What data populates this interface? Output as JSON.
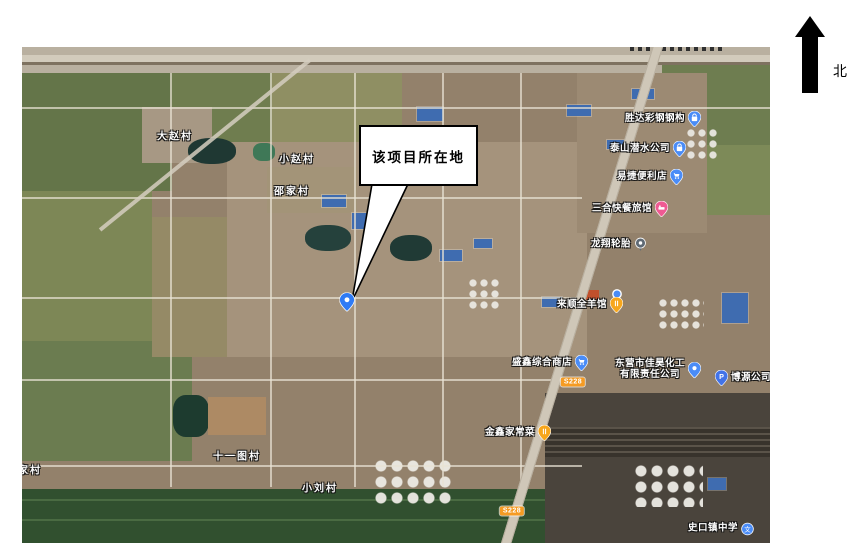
{
  "figure": {
    "north_label": "北"
  },
  "callout": {
    "text": "该项目所在地"
  },
  "map": {
    "villages": [
      {
        "label": "大赵村",
        "x": 153,
        "y": 88
      },
      {
        "label": "小赵村",
        "x": 275,
        "y": 111
      },
      {
        "label": "邵家村",
        "x": 270,
        "y": 143
      },
      {
        "label": "十一图村",
        "x": 215,
        "y": 408
      },
      {
        "label": "小刘村",
        "x": 298,
        "y": 440
      },
      {
        "label": "家村",
        "x": 8,
        "y": 422
      }
    ],
    "pois": [
      {
        "label": "胜达彩钢钢构",
        "icon": "bag",
        "x": 641,
        "y": 72
      },
      {
        "label": "泰山潜水公司",
        "icon": "bag",
        "x": 626,
        "y": 102
      },
      {
        "label": "易捷便利店",
        "icon": "cart",
        "x": 628,
        "y": 130
      },
      {
        "label": "三合快餐旅馆",
        "icon": "bed",
        "x": 608,
        "y": 162
      },
      {
        "label": "龙翔轮胎",
        "icon": "dot-marker",
        "x": 597,
        "y": 198
      },
      {
        "label": "",
        "icon": "blue-dot",
        "x": 595,
        "y": 247
      },
      {
        "label": "来顺全羊馆",
        "icon": "food",
        "x": 568,
        "y": 258
      },
      {
        "label": "盛鑫综合商店",
        "icon": "cart",
        "x": 528,
        "y": 316
      },
      {
        "label": "东营市佳昊化工",
        "label2": "有限责任公司",
        "icon": "pin",
        "x": 636,
        "y": 323
      },
      {
        "label": "博源公司停车场",
        "icon": "parking",
        "icon_first": true,
        "x": 736,
        "y": 331
      },
      {
        "label": "金鑫家常菜",
        "icon": "food",
        "x": 496,
        "y": 386
      },
      {
        "label": "史口镇中学",
        "icon": "school",
        "x": 699,
        "y": 482
      },
      {
        "label": "",
        "icon": "project-pin",
        "x": 325,
        "y": 255
      }
    ],
    "road_badges": [
      {
        "text": "S228",
        "x": 551,
        "y": 335
      },
      {
        "text": "S228",
        "x": 490,
        "y": 464
      }
    ]
  },
  "colors": {
    "poi_blue": "#4a8cf7",
    "poi_pink": "#ef5a93",
    "poi_orange": "#f7a61b",
    "poi_gray": "#5f6a75",
    "parking_blue": "#4273e8",
    "marker_blue": "#2f7bf5",
    "road_badge": "#f59b23"
  }
}
